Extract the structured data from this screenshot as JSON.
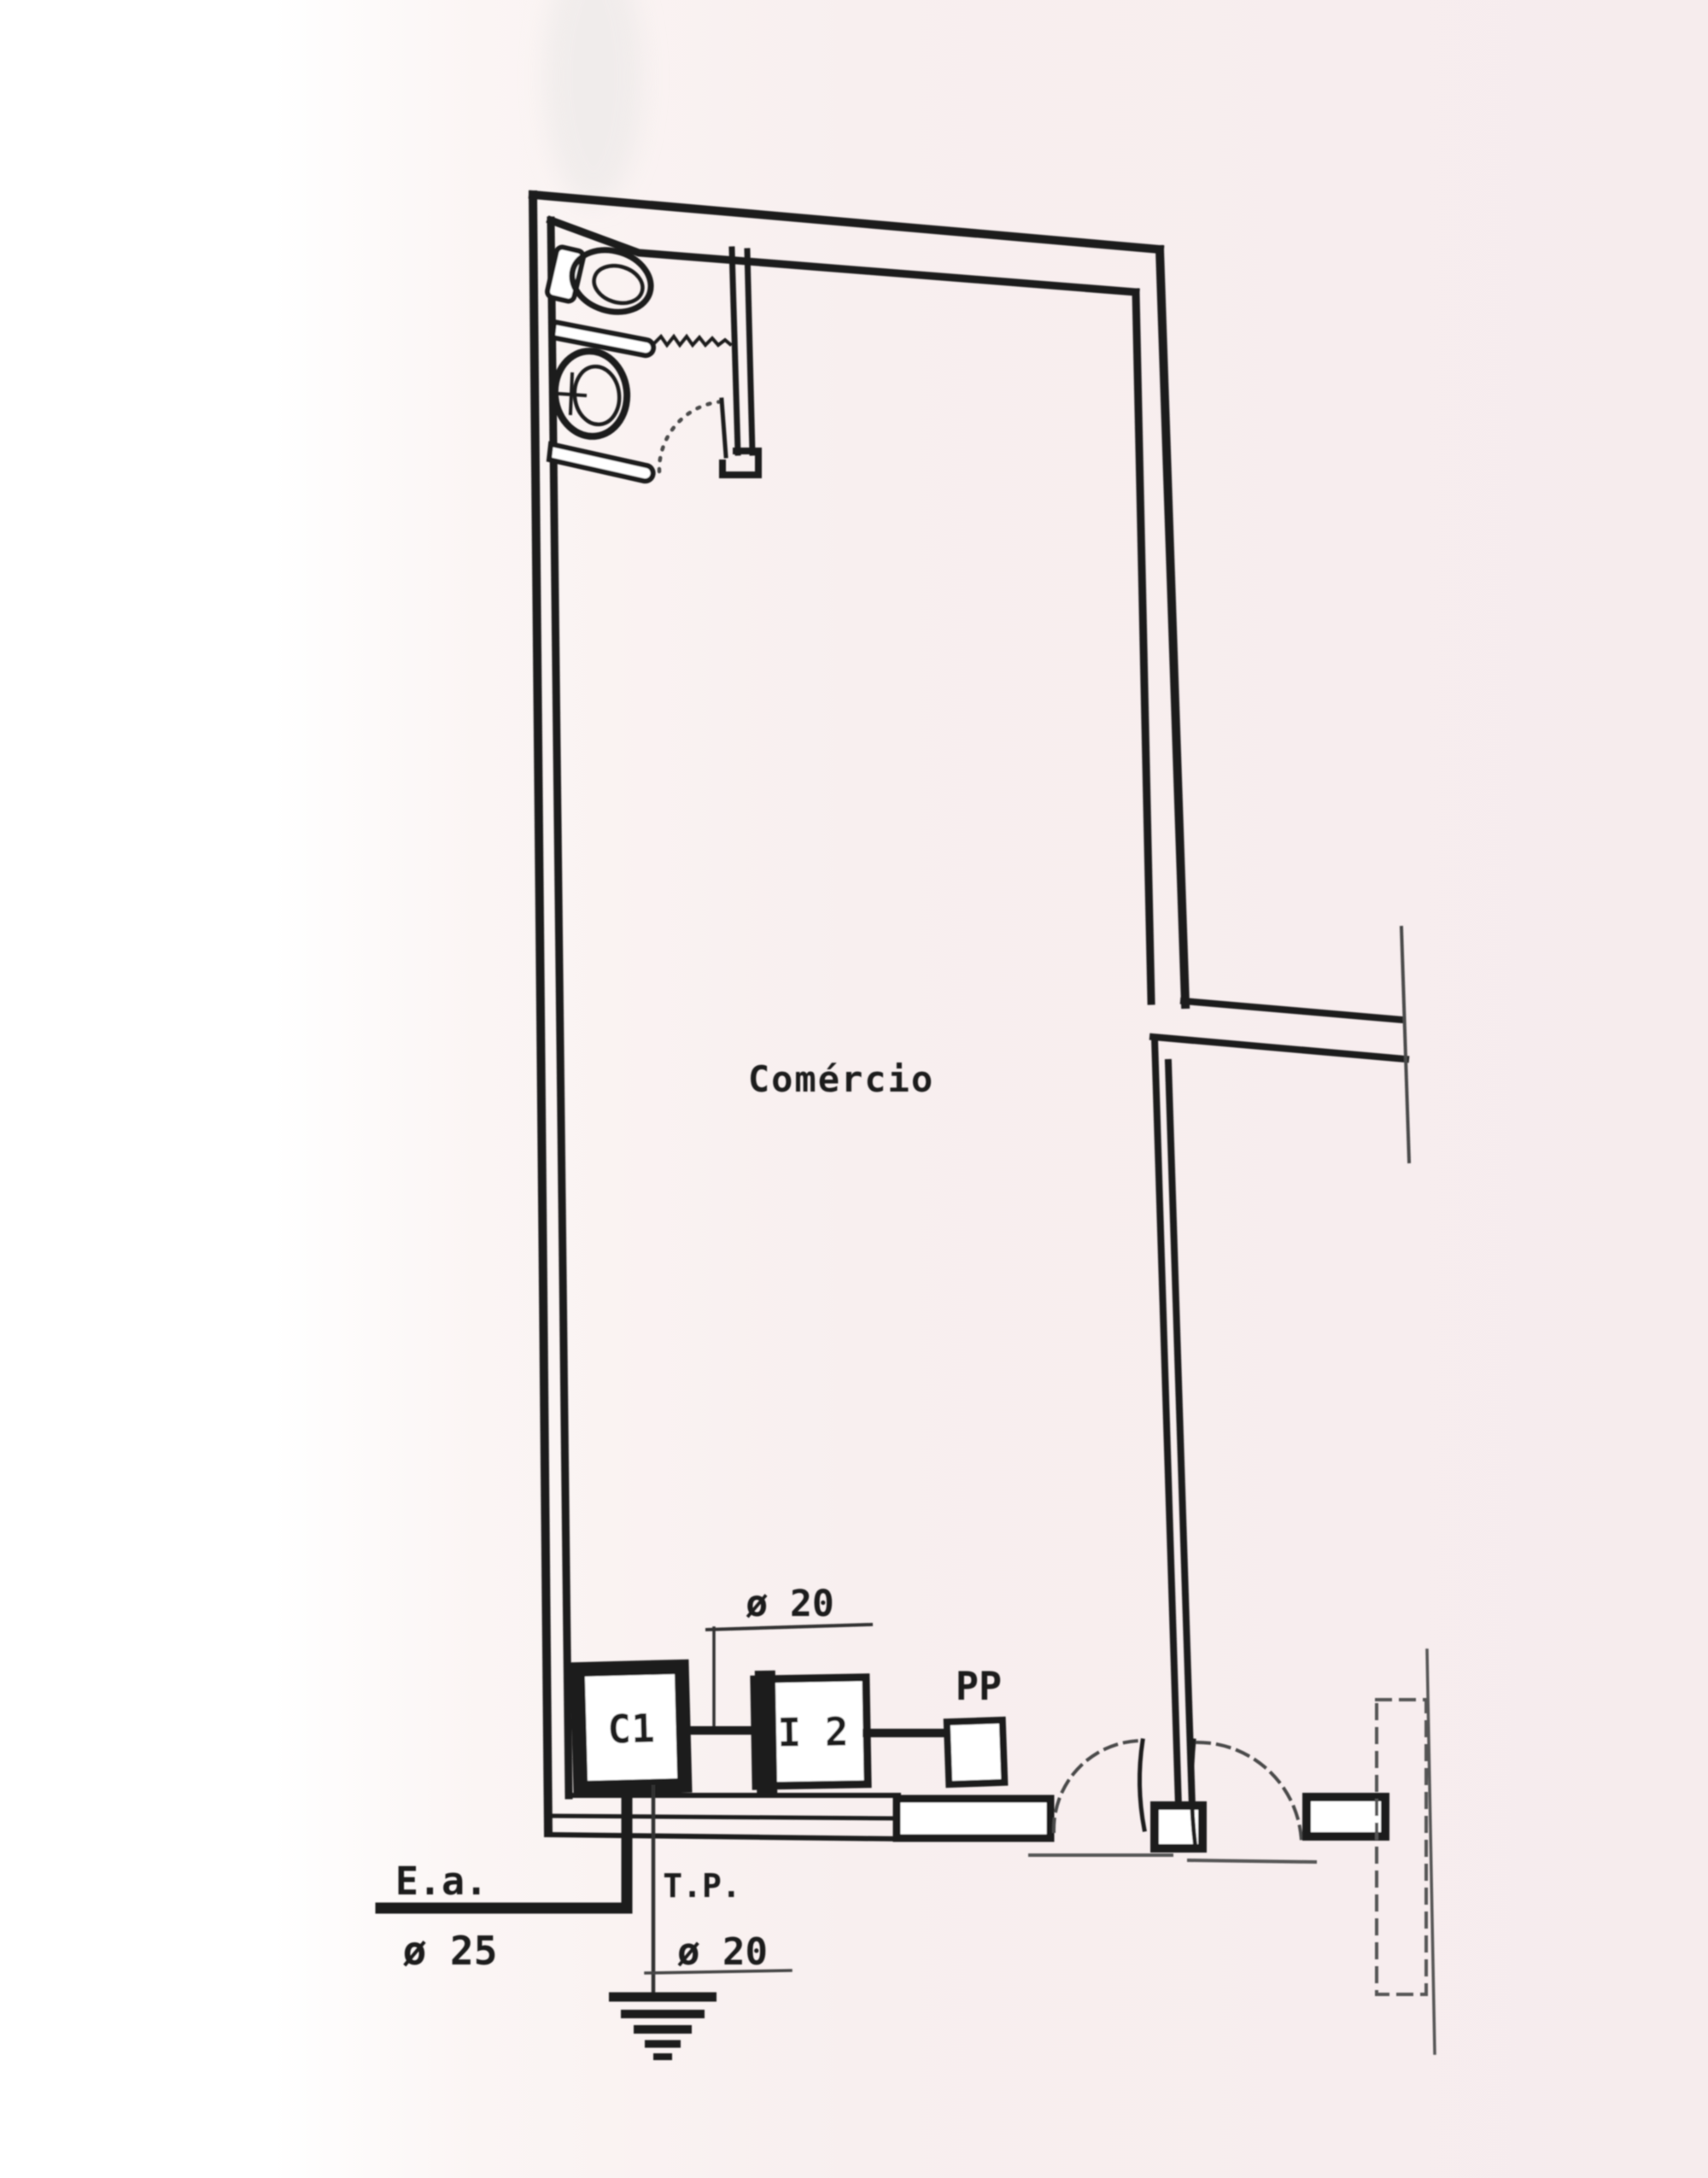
{
  "palette": {
    "paper_tint": "#f7edee",
    "paper_white": "#ffffff",
    "ink": "#1f1f1f",
    "light_ink": "#4a4a4a"
  },
  "plan": {
    "room_label": "Comércio",
    "devices": {
      "c1": "C1",
      "i2": "I 2",
      "pp": "PP"
    },
    "annotations": {
      "upper_conduit": "ø 20",
      "service_entry": "E.a.",
      "service_entry_conduit": "ø 25",
      "ground": "T.P.",
      "ground_conduit": "ø 20"
    }
  }
}
